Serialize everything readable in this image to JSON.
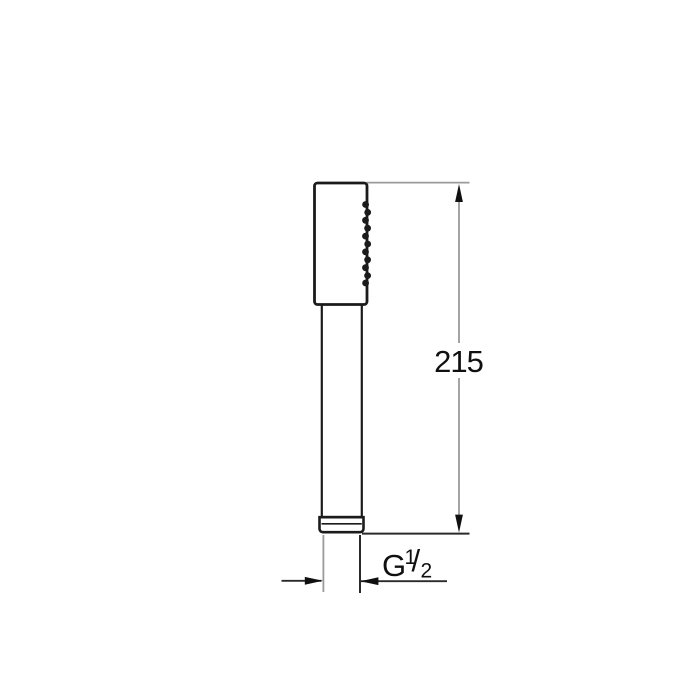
{
  "drawing": {
    "kind": "technical-dimension-drawing",
    "subject": "stick hand shower, side view",
    "background": "#ffffff",
    "colors": {
      "object_outline": "#1b1b1b",
      "extension_line_gray": "#9a9a9a",
      "dimension_line_dark": "#2a2a2a",
      "arrow": "#101010",
      "label": "#101010",
      "halo": "#ffffff"
    },
    "height_dimension": {
      "value": "215"
    },
    "thread_dimension": {
      "prefix": "G",
      "numerator": "1",
      "slash": "/",
      "denominator": "2"
    }
  }
}
